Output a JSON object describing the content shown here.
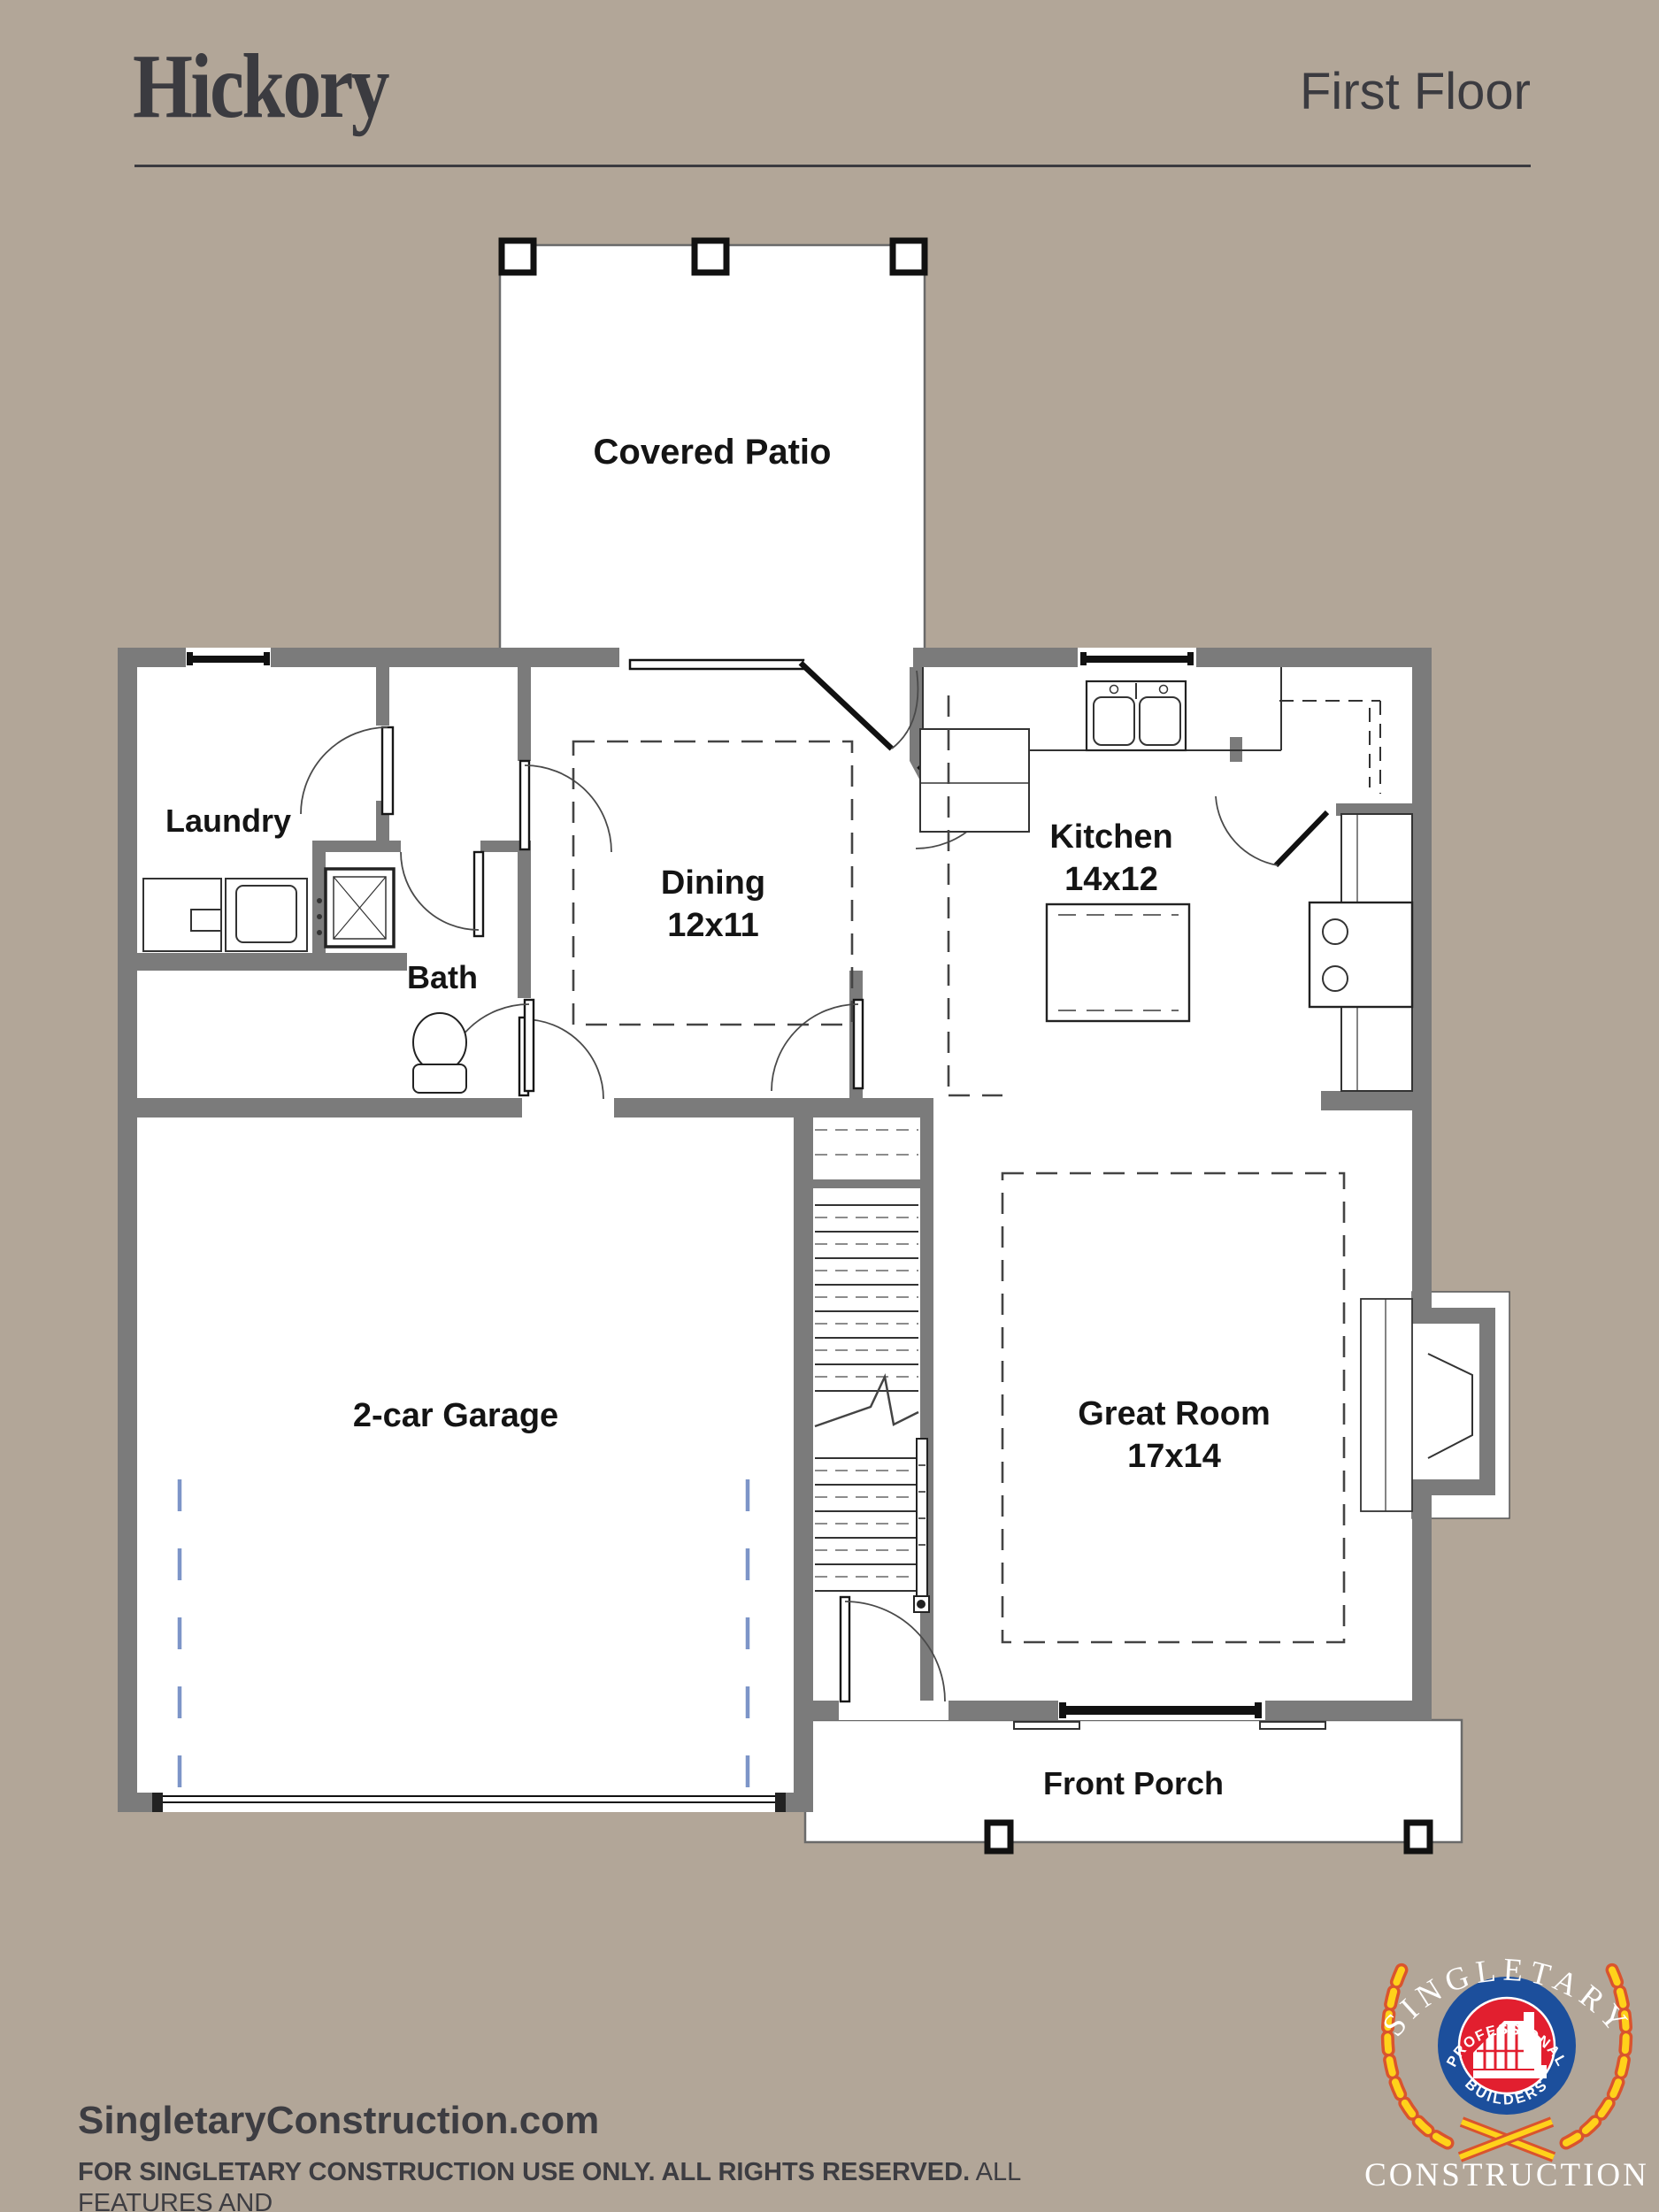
{
  "header": {
    "title": "Hickory",
    "subtitle": "First Floor"
  },
  "rooms": {
    "covered_patio": {
      "label": "Covered Patio"
    },
    "laundry": {
      "label": "Laundry"
    },
    "bath": {
      "label": "Bath"
    },
    "dining": {
      "label": "Dining",
      "dims": "12x11"
    },
    "kitchen": {
      "label": "Kitchen",
      "dims": "14x12"
    },
    "garage": {
      "label": "2-car Garage"
    },
    "great_room": {
      "label": "Great Room",
      "dims": "17x14"
    },
    "front_porch": {
      "label": "Front Porch"
    }
  },
  "footer": {
    "website": "SingletaryConstruction.com",
    "disclaimer_bold": "FOR SINGLETARY CONSTRUCTION USE ONLY. ALL RIGHTS RESERVED.",
    "disclaimer_line1_rest": " ALL FEATURES AND",
    "disclaimer_line2": "DIMENSIONS ARE APPROXIMATE and subject to change without notice. Buyer to verify all pertinent facts."
  },
  "logo": {
    "arc_top": "SINGLETARY",
    "ring_top": "PROFESSIONAL",
    "ring_bottom": "BUILDERS",
    "bottom": "CONSTRUCTION"
  },
  "colors": {
    "background": "#b2a698",
    "wall_gray": "#7b7b7b",
    "ink": "#3b3b40",
    "logo_blue": "#1c4f9c",
    "logo_red": "#e21f2f",
    "logo_gold": "#ffd21a",
    "garage_dash_blue": "#7d95c8"
  }
}
